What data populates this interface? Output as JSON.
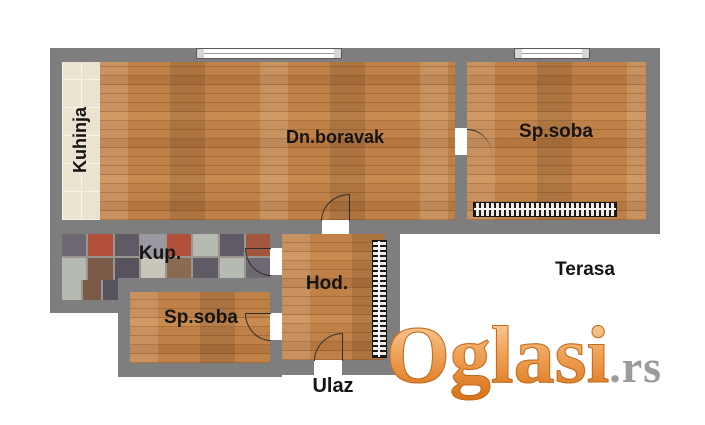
{
  "rooms": {
    "kitchen": {
      "label": "Kuhinja"
    },
    "living": {
      "label": "Dn.boravak"
    },
    "bedroom_top": {
      "label": "Sp.soba"
    },
    "bathroom": {
      "label": "Kup."
    },
    "bedroom_bottom": {
      "label": "Sp.soba"
    },
    "hallway": {
      "label": "Hod."
    },
    "terrace": {
      "label": "Terasa"
    },
    "entrance": {
      "label": "Ulaz"
    }
  },
  "watermark": {
    "brand": "Oglasi",
    "tld": ".rs"
  },
  "colors": {
    "wall_gray": "#7e7e7e",
    "wood_floor": "#c08148",
    "kitchen_tile": "#eae3d0",
    "label_black": "#141414",
    "watermark_orange": "#e8943f",
    "watermark_gray": "#9b9b9b",
    "radiator_black": "#1a1a1a"
  },
  "bathroom_tiles": {
    "palette": [
      "#5f5a66",
      "#b2503c",
      "#6e6873",
      "#9a98a0",
      "#b6bbb2",
      "#7b5a47",
      "#8a6a50",
      "#57525e",
      "#a4553e",
      "#c9c5ba"
    ],
    "main": [
      2,
      1,
      0,
      3,
      1,
      4,
      0,
      8,
      4,
      5,
      7,
      9,
      6,
      0,
      4,
      2
    ],
    "ext": [
      4,
      5,
      7
    ]
  }
}
